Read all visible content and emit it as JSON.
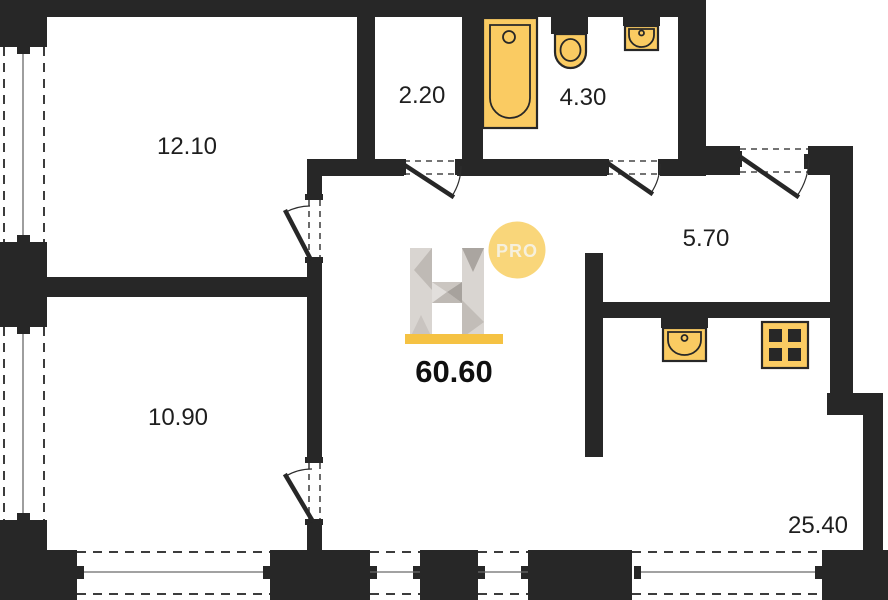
{
  "title": "Apartment floor plan",
  "total_area": "60.60",
  "logo": {
    "badge": "PRO"
  },
  "rooms": [
    {
      "name": "bedroom-1",
      "area": "12.10"
    },
    {
      "name": "storage",
      "area": "2.20"
    },
    {
      "name": "bathroom",
      "area": "4.30"
    },
    {
      "name": "entry-hall",
      "area": "5.70"
    },
    {
      "name": "bedroom-2",
      "area": "10.90"
    },
    {
      "name": "kitchen-living",
      "area": "25.40"
    }
  ],
  "fixtures": [
    {
      "name": "bathtub"
    },
    {
      "name": "toilet"
    },
    {
      "name": "bathroom-sink"
    },
    {
      "name": "kitchen-sink"
    },
    {
      "name": "stove"
    }
  ],
  "colors": {
    "wall": "#272727",
    "fixture_fill": "#FACB62",
    "accent_bar": "#F5C243",
    "badge_fill": "#F9D67A",
    "paper": "#ffffff"
  }
}
